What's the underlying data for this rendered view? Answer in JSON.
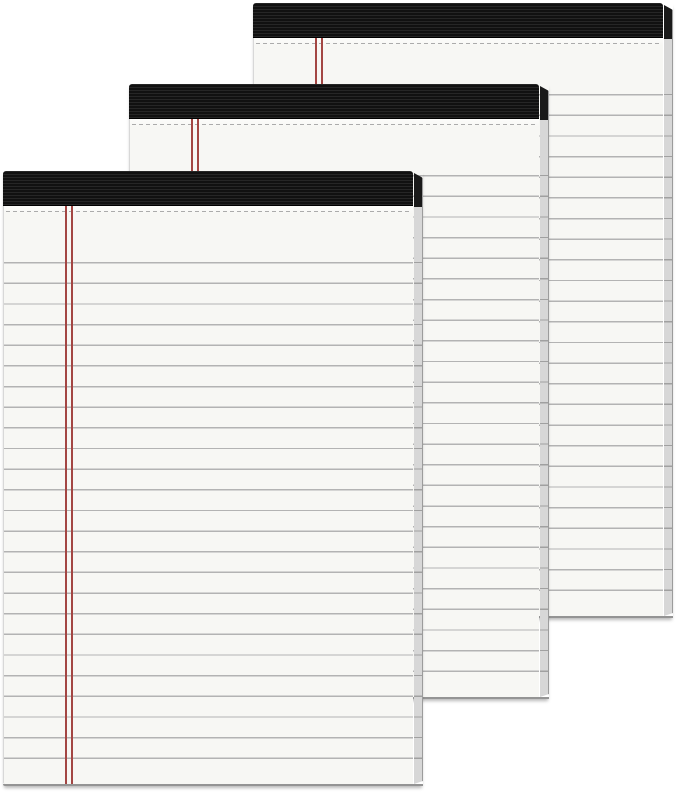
{
  "scene": {
    "type": "product-photo",
    "description": "Three blank white legal-ruled writing note pads with black ribbed bindings, fanned diagonally from top-right (back) to bottom-left (front) on a white background",
    "notepad_count": 3
  },
  "theme": {
    "bg_color": "#ffffff",
    "paper_color": "#f7f7f4",
    "paper_top_color": "#fdfdfc",
    "paper_edge_color": "#d8d8d8",
    "rule_line_color": "#b3b3b3",
    "margin_line_color": "#a34643",
    "binding_color": "#111111",
    "binding_stripe_color": "#262626",
    "bevel_color": "#d7d7d7",
    "bevel_dark_color": "#1a1a1a",
    "bevel_edge_color": "#9c9c9c",
    "bottom_edge_color": "#949494",
    "perforation_color": "#ababab"
  },
  "metrics": {
    "pad_width": 420,
    "pad_height": 615,
    "binding_height": 35,
    "bevel_width": 9,
    "line_spacing": 20.65,
    "line_thickness": 1.4,
    "first_line_y": 91,
    "perforation_y": 39.5,
    "margin_line_x": 60.5,
    "margin_line_width": 2,
    "margin_line_gap": 4,
    "ruled_line_count": 25
  },
  "pads": [
    {
      "id": "back",
      "left": 253,
      "top": 3
    },
    {
      "id": "middle",
      "left": 129,
      "top": 84
    },
    {
      "id": "front",
      "left": 3,
      "top": 171
    }
  ]
}
